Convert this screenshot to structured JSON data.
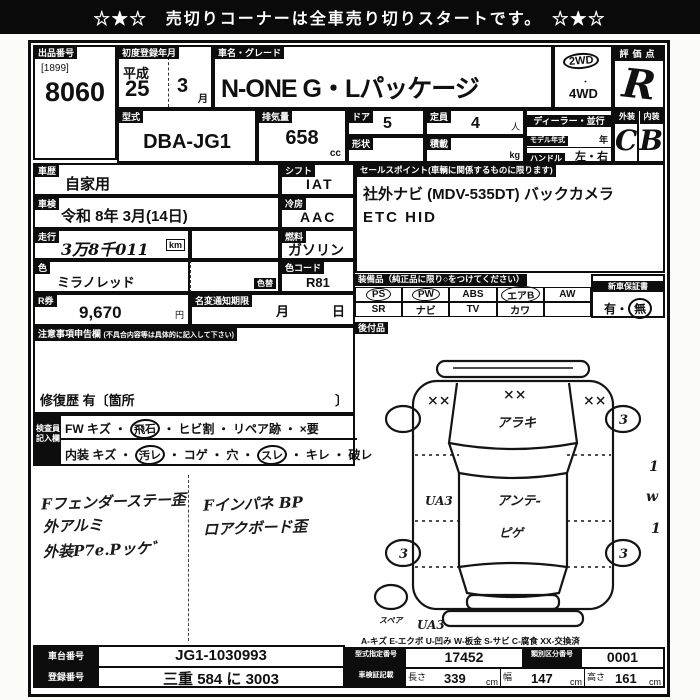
{
  "banner": {
    "text": "☆★☆　売切りコーナーは全車売り切りスタートです。　☆★☆"
  },
  "lot": {
    "label": "出品番号",
    "bracket": "[1899]",
    "number": "8060"
  },
  "reg": {
    "label": "初度登録年月",
    "era": "平成",
    "year": "25",
    "month": "3",
    "month_unit": "月"
  },
  "name": {
    "label": "車名・グレード",
    "value": "N-ONE G・Lパッケージ"
  },
  "drive": {
    "d2": "2WD",
    "dot": "・",
    "d4": "4WD"
  },
  "score": {
    "label": "評価点",
    "value": "R"
  },
  "grade": {
    "ext_label": "外装",
    "int_label": "内装",
    "ext": "C",
    "int": "B"
  },
  "specs": {
    "model_label": "型式",
    "model": "DBA-JG1",
    "disp_label": "排気量",
    "disp": "658",
    "disp_unit": "cc",
    "door_label": "ドア",
    "door": "5",
    "cap_label": "定員",
    "cap": "4",
    "cap_unit": "人",
    "shape_label": "形状",
    "load_label": "積載",
    "load_unit": "kg",
    "dealer": "ディーラー・並行",
    "modelyear_label": "モデル年式",
    "modelyear_unit": "年",
    "handle_label": "ハンドル",
    "handle": "左・右"
  },
  "left": {
    "history_label": "車歴",
    "history": "自家用",
    "shift_label": "シフト",
    "shift": "IAT",
    "shaken_label": "車検",
    "shaken": "令和 8年 3月(14日)",
    "ac_label": "冷房",
    "ac": "AAC",
    "mileage_label": "走行",
    "mileage": "3万8千011",
    "mileage_unit": "km",
    "fuel_label": "燃料",
    "fuel": "ガソリン",
    "color_label": "色",
    "color": "ミラノレッド",
    "colorchg_label": "色替",
    "colorcode_label": "色コード",
    "colorcode": "R81",
    "rticket_label": "R券",
    "rticket": "9,670",
    "yen": "円",
    "namechange_label": "名変通知期限",
    "month": "月",
    "day": "日"
  },
  "sales": {
    "header": "セールスポイント(車輌に関係するものに限ります)",
    "line1": "社外ナビ (MDV-535DT)  バックカメラ",
    "line2": "ETC HID"
  },
  "equipment": {
    "header": "装備品（純正品に限り○をつけてください）",
    "ps": "PS",
    "pw": "PW",
    "abs": "ABS",
    "airb": "エアB",
    "aw": "AW",
    "sr": "SR",
    "navi": "ナビ",
    "tv": "TV",
    "leather": "カワ",
    "warranty_label": "新車保証書",
    "warranty_yes": "有",
    "warranty_sep": "・",
    "warranty_no": "無",
    "aftermarket_label": "後付品"
  },
  "caution": {
    "header": "注意事項申告欄",
    "header_small": "(不具合内容等は具体的に記入して下さい)",
    "repair": "修復歴 有〔箇所",
    "repair_close": "〕"
  },
  "inspector": {
    "label1": "検査員",
    "label2": "記入欄",
    "fw_pre": "FW キズ ・",
    "fw_circ": "飛石",
    "fw_post": "・ ヒビ割 ・ リペア跡 ・ ×要",
    "in_pre": "内装 キズ ・",
    "in_circ1": "汚レ",
    "in_mid": "・ コゲ ・ 穴 ・",
    "in_circ2": "スレ",
    "in_post": "・ キレ ・ 破レ"
  },
  "handwritten": {
    "l1": "Fフェンダーステー歪",
    "l2": "外アルミ",
    "l3": "外装P7e.Pッケ゛",
    "r1": "Fインパネ BP",
    "r2": "ロアクボード歪"
  },
  "diagram": {
    "xx_left": "××",
    "xx_center": "××",
    "xx_right": "××",
    "hood_note": "アラキ",
    "roof_note": "アンテ-",
    "hatch_note": "ピゲ",
    "side_note": "UA3",
    "rear_note": "UA3",
    "wheel_mark": "3",
    "spare_label": "スペア",
    "margin1": "1",
    "margin2": "w",
    "margin3": "1",
    "legend": "A-キズ  E-エクボ  U-凹み  W-板金  S-サビ  C-腐食  XX-交換済"
  },
  "bottom": {
    "chassis_label": "車台番号",
    "chassis": "JG1-1030993",
    "plate_label": "登録番号",
    "plate": "三重 584 に 3003",
    "typeno_label": "型式指定番号",
    "typeno": "17452",
    "classno_label": "類別区分番号",
    "classno": "0001",
    "dims_label": "車検証記載",
    "len_label": "長さ",
    "len": "339",
    "wid_label": "幅",
    "wid": "147",
    "hgt_label": "高さ",
    "hgt": "161",
    "cm": "cm"
  }
}
